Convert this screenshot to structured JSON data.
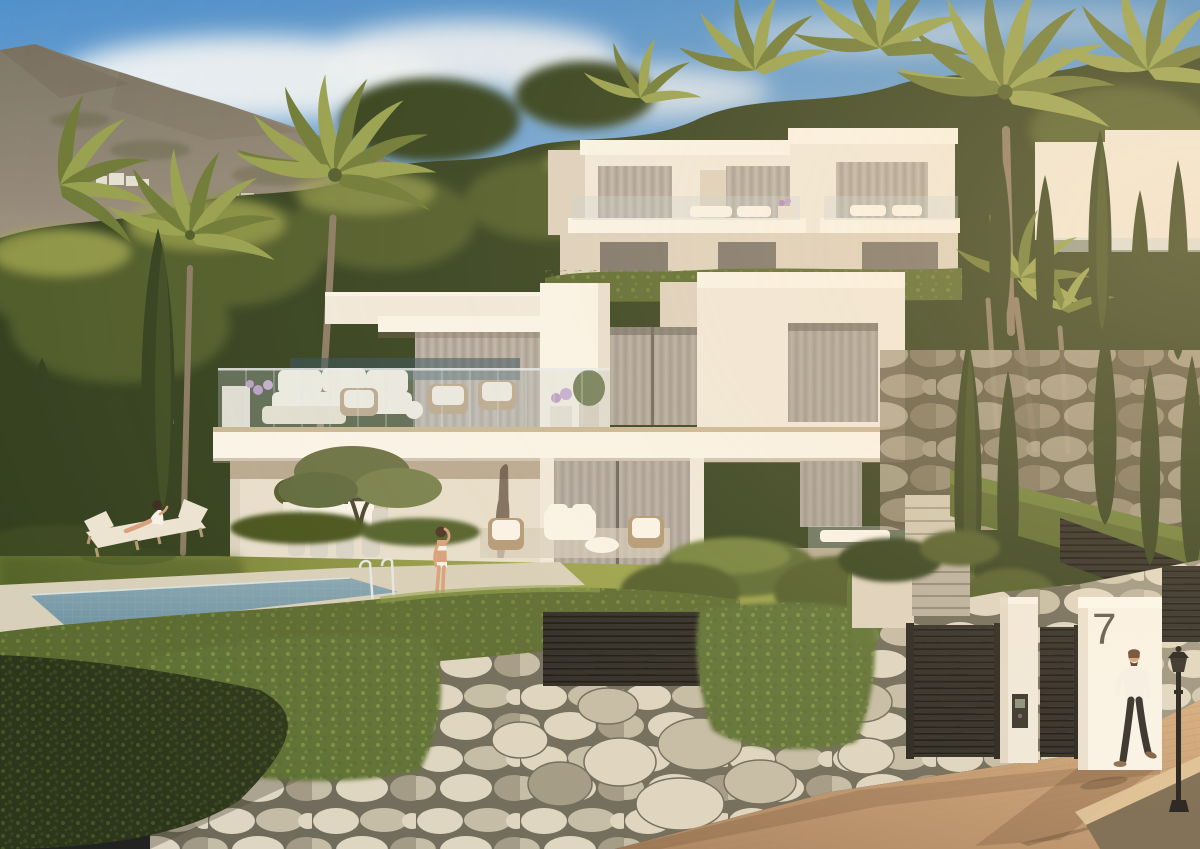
{
  "scene": {
    "description": "Golden-hour render of modern white hillside villas with roof terraces, palm and cypress trees, a lawn with sun loungers, a rectangular pool, an ivy-covered stone wall, black slatted entrance gates and a brick driveway",
    "house_number": "7"
  },
  "people": {
    "woman_lounging": "woman seated on sun lounger",
    "woman_poolside": "woman in white bikini beside pool",
    "man_walking": "man in white shirt walking on driveway"
  },
  "palette": {
    "sky-top": "#4f90cc",
    "sky-horizon": "#aecbe6",
    "cloud": "#edf2f6",
    "mountain-top": "#7d7766",
    "mountain-mid": "#938878",
    "mountain-haze": "#b3a691",
    "mountain-shadow": "#6b5f4e",
    "tree-dark": "#33401f",
    "tree-mid": "#4f5c2a",
    "tree-sun": "#a3aa52",
    "palm": "#6d7a36",
    "palm-light": "#96a14e",
    "trunk": "#8a7a64",
    "villa-white": "#f1eadd",
    "villa-bright": "#faf5ea",
    "villa-shade": "#ddd2c0",
    "glass": "#9b948e",
    "curtain-light": "#cdc5ba",
    "curtain-dark": "#a89f95",
    "hedge": "#5a6a30",
    "hedge-light": "#7e8f41",
    "lawn-sun": "#9aa24c",
    "lawn-shade": "#66742f",
    "pool-water": "#87a6b2",
    "pool-deep": "#6f93a2",
    "coping": "#d8d0ba",
    "stone-light": "#ded6c2",
    "stone-mid": "#c4bca6",
    "stone-dark": "#a29a86",
    "grout": "#6e6a5a",
    "ivy": "#5d7134",
    "ivy-light": "#8fa04a",
    "gate-dark": "#2b2925",
    "slat-gap": "#15130e",
    "drive-sun": "#d4ac80",
    "drive-shade": "#a8825e",
    "brick-line": "#b68f69",
    "skin": "#d8a07d",
    "shirt-white": "#f6f2ea",
    "pants-dark": "#2e2a28",
    "lounger-cream": "#ece4d2",
    "rattan": "#b39a77",
    "number": "#5a5751"
  }
}
